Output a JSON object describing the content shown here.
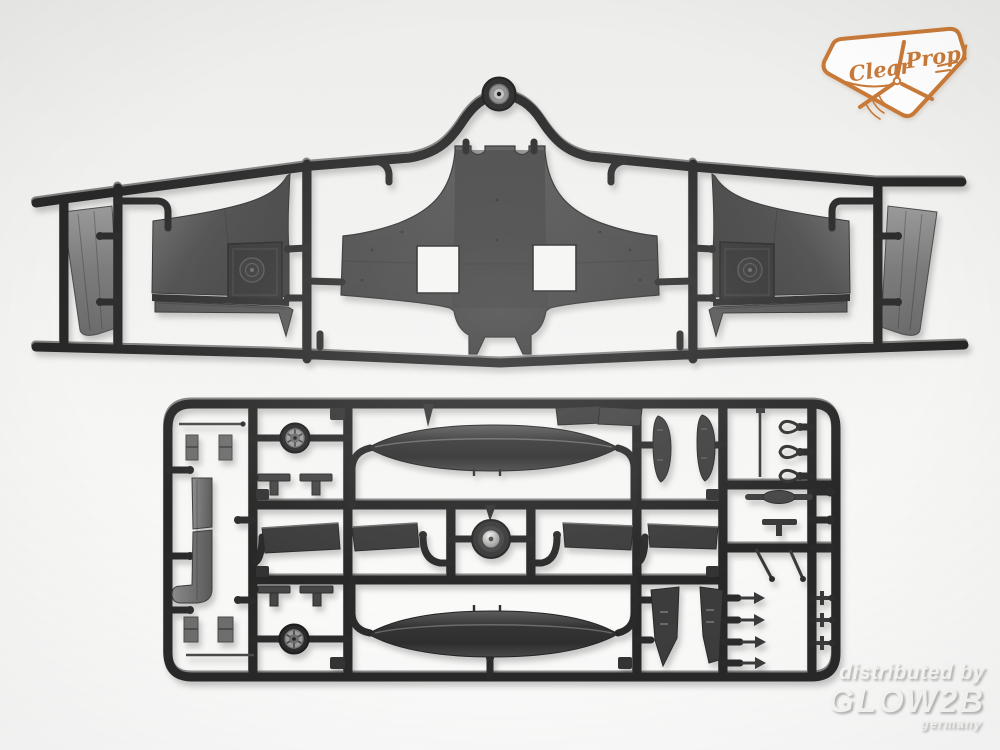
{
  "image": {
    "width": 1000,
    "height": 750,
    "background": "#f2f2f0",
    "subject": "model kit sprue product photo"
  },
  "brand_badge": {
    "brand": "Clear Prop!",
    "word_left": "Clear",
    "word_right": "Prop!",
    "color": "#c97a38",
    "icon": "propeller-icon"
  },
  "watermark": {
    "line1": "distributed by",
    "line2": "GLOW2B",
    "line3": "germany",
    "color": "#fbfbfa"
  },
  "plastic_colors": {
    "runner_dark": "#282828",
    "panel_mid": "#4a4a4a",
    "panel_light": "#8d8d8d",
    "hub_light": "#a0a0a0",
    "spinner_bright": "#e6e6e6"
  },
  "sprues": {
    "top": {
      "name": "wing sprue",
      "parts": [
        "tail wheel",
        "lower wing center section with wheel-well openings",
        "upper wing panel left",
        "upper wing panel right",
        "flap strip left",
        "flap strip right",
        "outer flap panel far left",
        "outer flap panel far right"
      ]
    },
    "bottom": {
      "name": "detail sprue",
      "parts": [
        "drop tank upper",
        "drop tank lower",
        "main wheel upper",
        "main wheel lower",
        "spinner backplate",
        "flap and aileron panels",
        "curved gear doors",
        "angular gear doors",
        "cowl strip J-shaped",
        "gear struts, forks and small fittings"
      ]
    }
  }
}
